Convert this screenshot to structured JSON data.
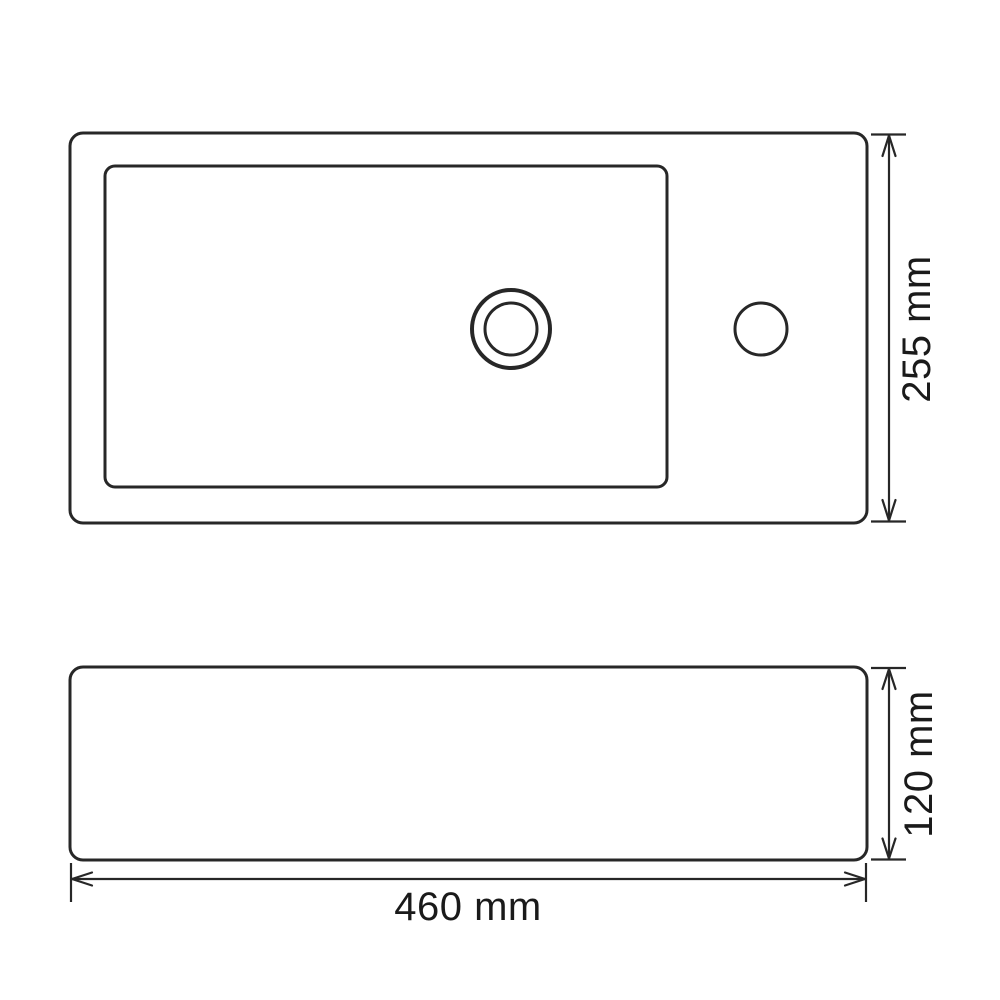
{
  "colors": {
    "background": "#ffffff",
    "line": "#272727",
    "text": "#1a1a1a"
  },
  "drawing": {
    "subject": "sink-dimension-drawing",
    "dimensions": {
      "top_view_depth": {
        "label": "255 mm",
        "value": 255,
        "unit": "mm"
      },
      "front_view_height": {
        "label": "120 mm",
        "value": 120,
        "unit": "mm"
      },
      "front_view_width": {
        "label": "460 mm",
        "value": 460,
        "unit": "mm"
      }
    }
  }
}
